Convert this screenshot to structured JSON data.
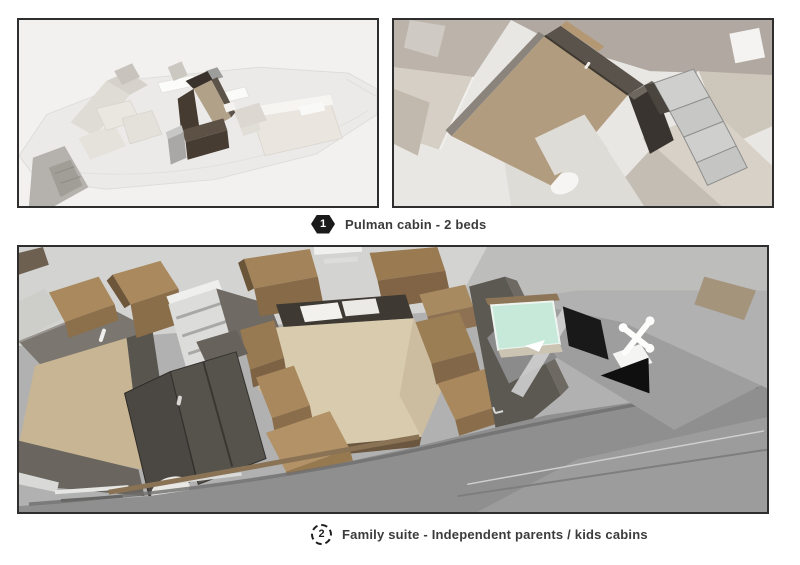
{
  "page": {
    "background": "#ffffff"
  },
  "figures": [
    {
      "number": "1",
      "badge_shape": "solid-hexagon",
      "caption": "Pulman cabin - 2 beds",
      "panels": [
        {
          "label": "deck-plan-overview-with-pulman-cabin-highlighted"
        },
        {
          "label": "pulman-cabin-top-view-closeup"
        }
      ]
    },
    {
      "number": "2",
      "badge_shape": "dashed-circle",
      "caption": "Family suite - Independent parents / kids cabins",
      "panels": [
        {
          "label": "family-suite-bow-cutaway-view"
        }
      ]
    }
  ],
  "palette": {
    "panel_border": "#2e2e2e",
    "panel1_bg": "#f2f1ef",
    "panel2_bg": "#e9e7e3",
    "panel3_bg": "#b1b1b1",
    "badge_fill": "#1a1a1a",
    "badge_text": "#ffffff",
    "caption_text": "#3b3b3b",
    "wood_tan": "#b19c7f",
    "dark_walnut": "#4a4036",
    "hull_gray": "#8f8f8f",
    "glass_teal": "#c7e9da"
  }
}
